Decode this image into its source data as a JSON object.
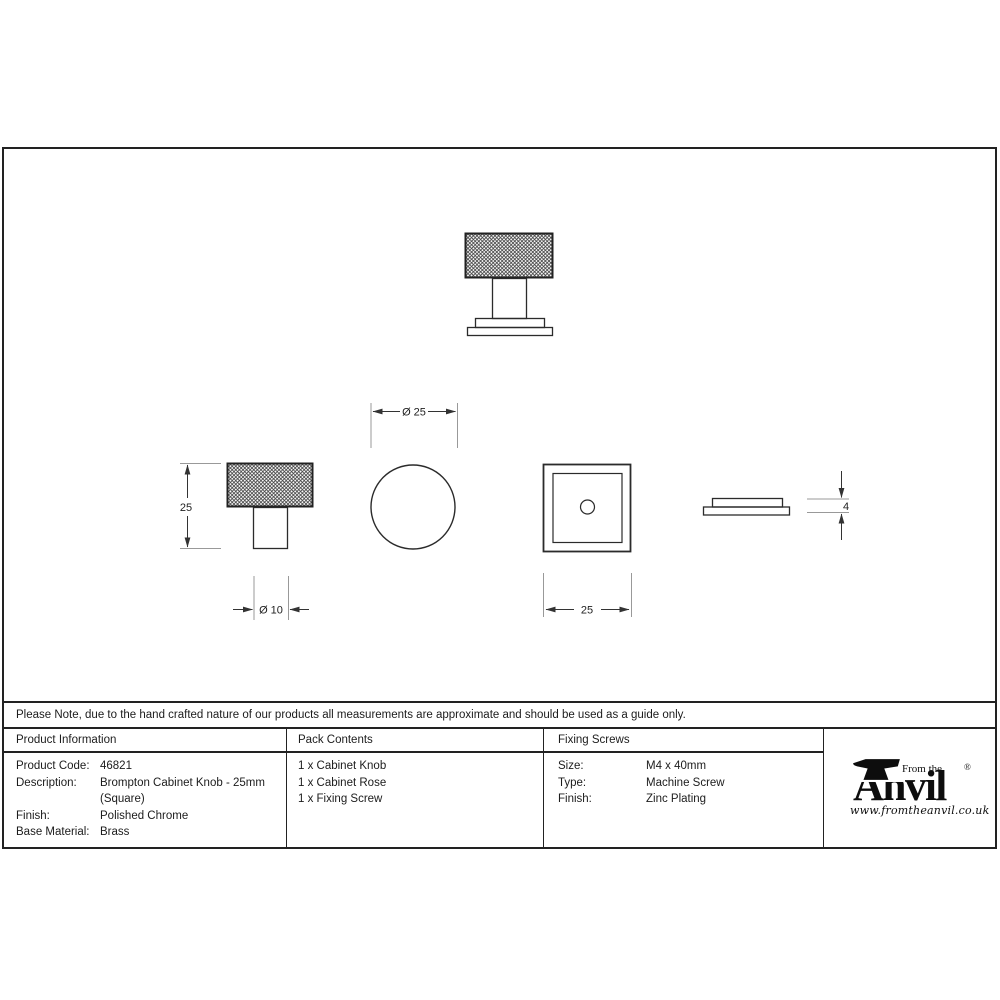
{
  "note": "Please Note, due to the hand crafted nature of our products all measurements are approximate and should be used as a guide only.",
  "dimensions": {
    "knob_height": "25",
    "stem_diameter": "Ø 10",
    "knob_diameter": "Ø 25",
    "rose_width": "25",
    "rose_thickness": "4"
  },
  "table": {
    "product_information": {
      "header": "Product Information",
      "rows": [
        {
          "label": "Product Code:",
          "value": "46821"
        },
        {
          "label": "Description:",
          "value": "Brompton Cabinet Knob - 25mm"
        },
        {
          "label": "",
          "value": "(Square)"
        },
        {
          "label": "Finish:",
          "value": "Polished Chrome"
        },
        {
          "label": "Base Material:",
          "value": "Brass"
        }
      ]
    },
    "pack_contents": {
      "header": "Pack Contents",
      "items": [
        "1 x Cabinet Knob",
        "1 x Cabinet Rose",
        "1 x Fixing Screw"
      ]
    },
    "fixing_screws": {
      "header": "Fixing Screws",
      "rows": [
        {
          "label": "Size:",
          "value": "M4 x 40mm"
        },
        {
          "label": "Type:",
          "value": "Machine Screw"
        },
        {
          "label": "Finish:",
          "value": "Zinc Plating"
        }
      ]
    }
  },
  "logo": {
    "from_the": "From the",
    "name": "Anvil",
    "registered": "®",
    "url": "www.fromtheanvil.co.uk"
  },
  "colors": {
    "line": "#222222",
    "dim_line": "#333333",
    "ext_line": "#999999",
    "text": "#1c1c1c"
  }
}
